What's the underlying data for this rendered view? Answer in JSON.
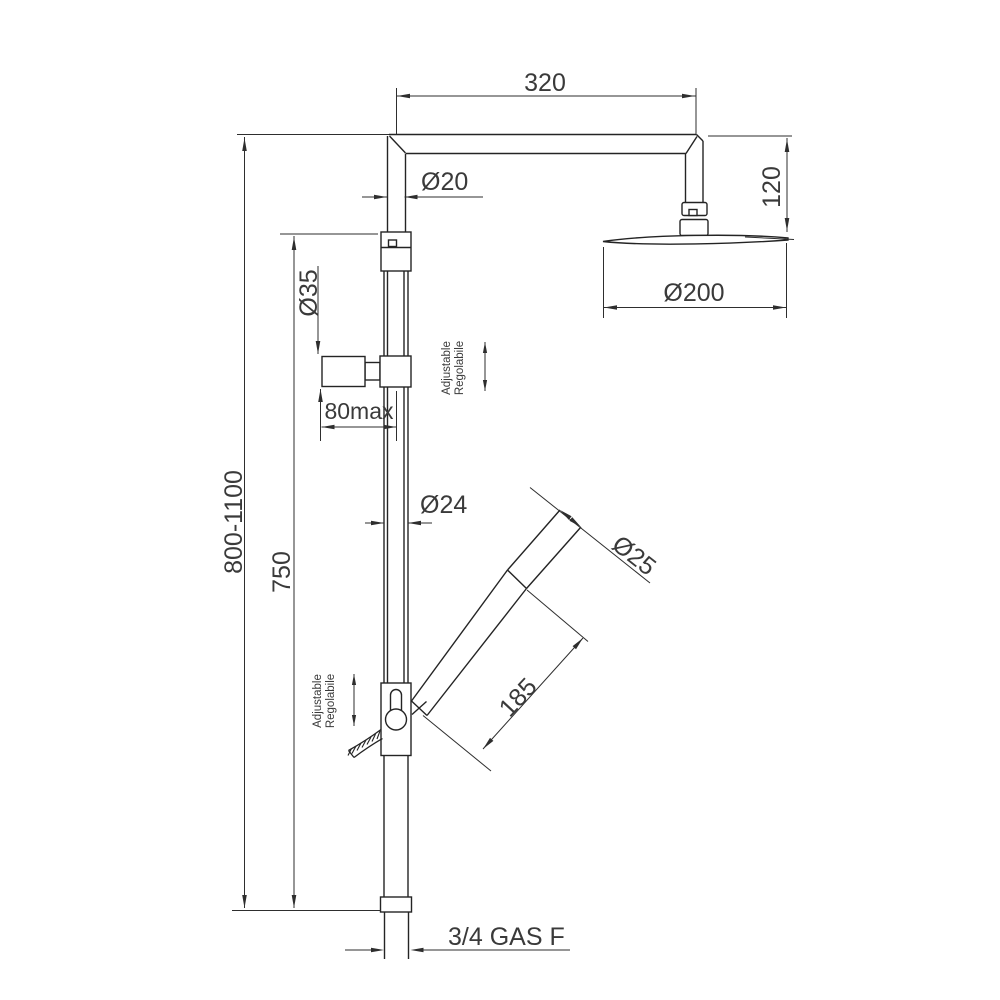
{
  "drawing": {
    "title": "Shower column technical drawing with dimensions",
    "background": "#ffffff",
    "line_color": "#242424",
    "text_color": "#3a3a3a",
    "dimensions": {
      "arm_length": "320",
      "upper_pipe_diameter": "Ø20",
      "head_drop_height": "120",
      "head_diameter": "Ø200",
      "wall_bracket_diameter": "Ø35",
      "wall_distance": "80max",
      "total_height_range": "800-1100",
      "rail_height": "750",
      "rail_diameter": "Ø24",
      "handshower_diameter": "Ø25",
      "handshower_length": "185",
      "bottom_connection": "3/4 GAS F"
    },
    "labels": {
      "adjustable_en": "Adjustable",
      "adjustable_it": "Regolabile"
    }
  }
}
